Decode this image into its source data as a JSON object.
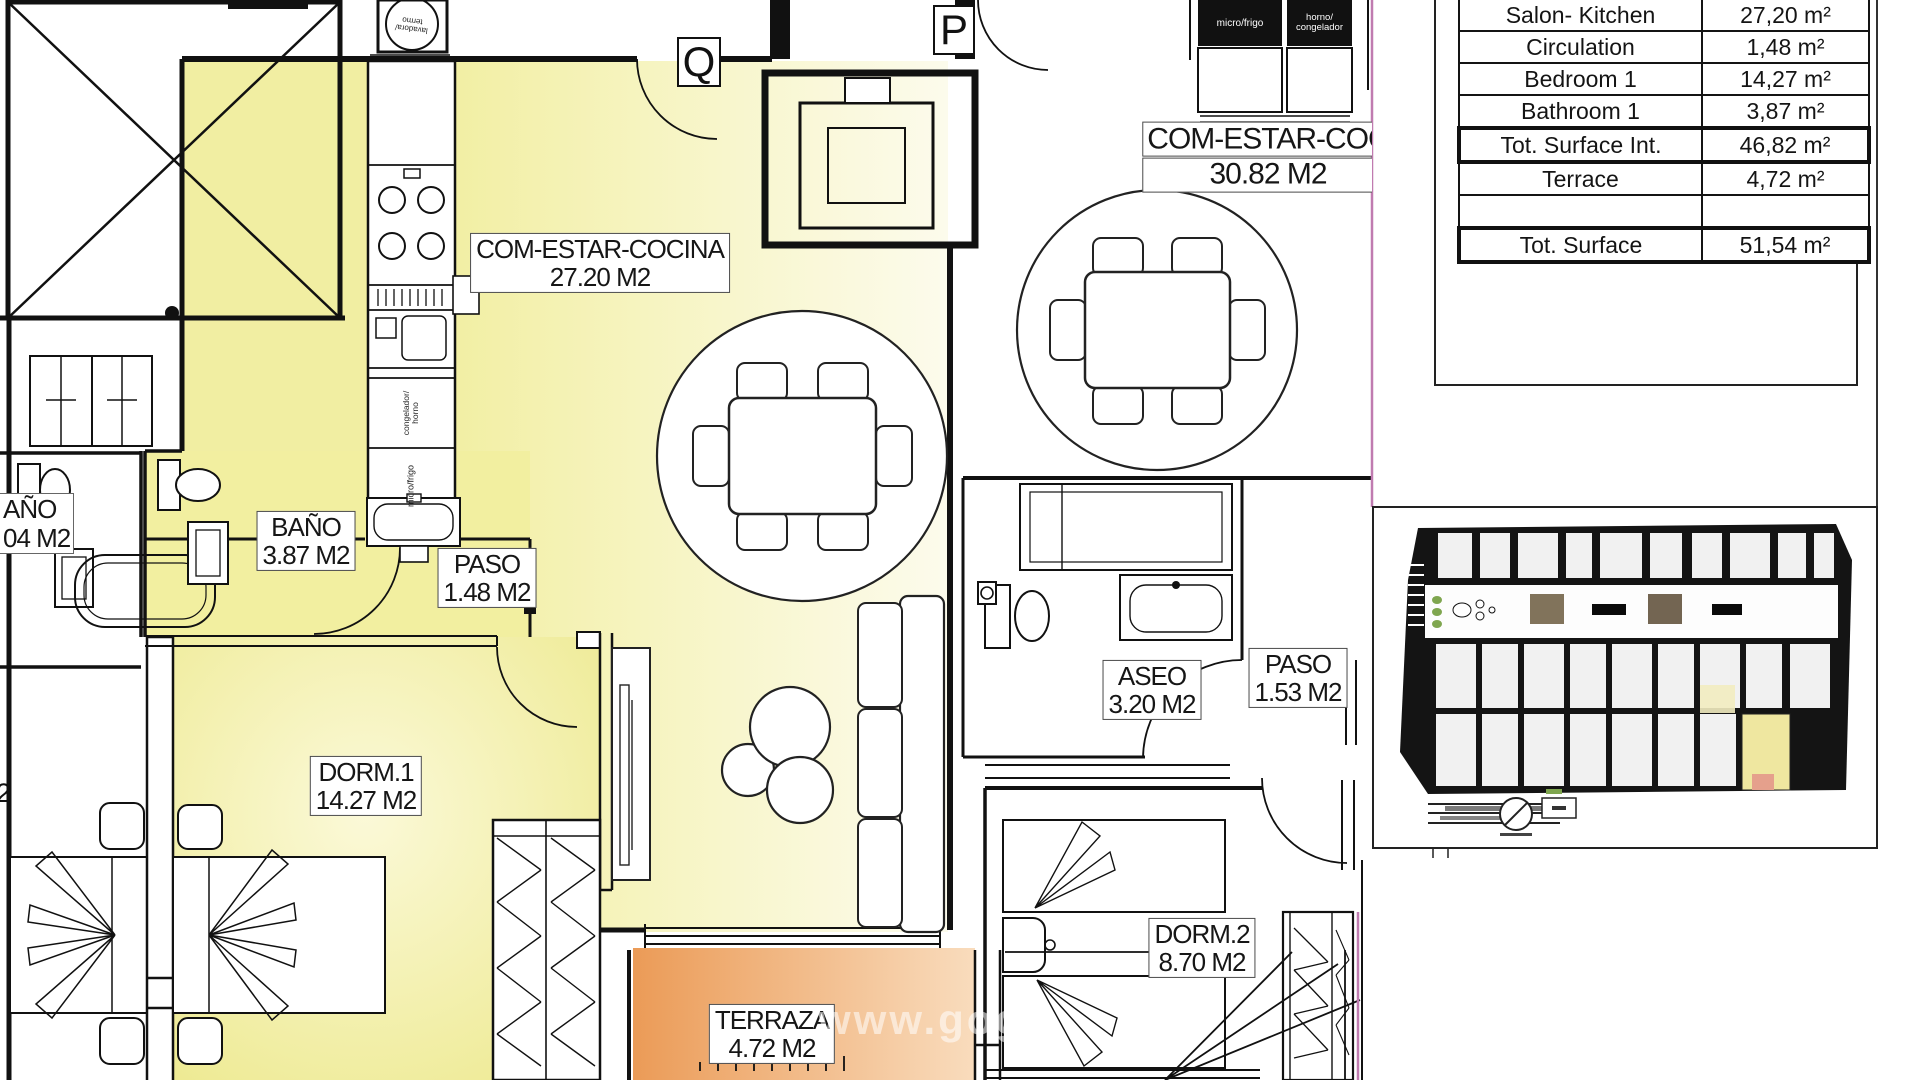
{
  "plan": {
    "apartments": {
      "q": {
        "letter": "Q",
        "rooms": {
          "salon": {
            "name": "COM-ESTAR-COCINA",
            "area": "27.20 M2"
          },
          "bano": {
            "name": "BAÑO",
            "area": "3.87 M2"
          },
          "paso": {
            "name": "PASO",
            "area": "1.48 M2"
          },
          "dorm1": {
            "name": "DORM.1",
            "area": "14.27 M2"
          },
          "terraza": {
            "name": "TERRAZA",
            "area": "4.72 M2"
          }
        }
      },
      "p": {
        "letter": "P",
        "rooms": {
          "salon": {
            "name": "COM-ESTAR-COC",
            "area": "30.82 M2"
          },
          "aseo": {
            "name": "ASEO",
            "area": "3.20 M2"
          },
          "paso": {
            "name": "PASO",
            "area": "1.53 M2"
          },
          "dorm2": {
            "name": "DORM.2",
            "area": "8.70 M2"
          }
        }
      },
      "neighbor": {
        "bath_name_partial": "AÑO",
        "bath_area_partial": "04 M2",
        "floor_digit_partial": "2"
      }
    },
    "appliances": {
      "lavadora_termo": "lavadora/ termo",
      "congelador_horno": "congelador/ horno",
      "micro_frigo_q": "micro/frigo",
      "micro_frigo_p": "micro/frigo",
      "horno_congelador_p": "horno/ congelador"
    }
  },
  "area_table": {
    "rows": [
      {
        "label": "Salon- Kitchen",
        "value": "27,20 m²"
      },
      {
        "label": "Circulation",
        "value": "1,48 m²"
      },
      {
        "label": "Bedroom 1",
        "value": "14,27 m²"
      },
      {
        "label": "Bathroom 1",
        "value": "3,87 m²"
      },
      {
        "label": "Tot. Surface Int.",
        "value": "46,82 m²"
      },
      {
        "label": "Terrace",
        "value": "4,72 m²"
      },
      {
        "label": "",
        "value": ""
      },
      {
        "label": "Tot. Surface",
        "value": "51,54 m²"
      }
    ]
  },
  "watermark": "www.gog",
  "colors": {
    "room_yellow": "#F1EEA2",
    "terrace_orange": "#EC9C58",
    "boundary_pink": "#C07BB0",
    "wall_black": "#111111",
    "mini_highlight": "#EFE7A0"
  }
}
